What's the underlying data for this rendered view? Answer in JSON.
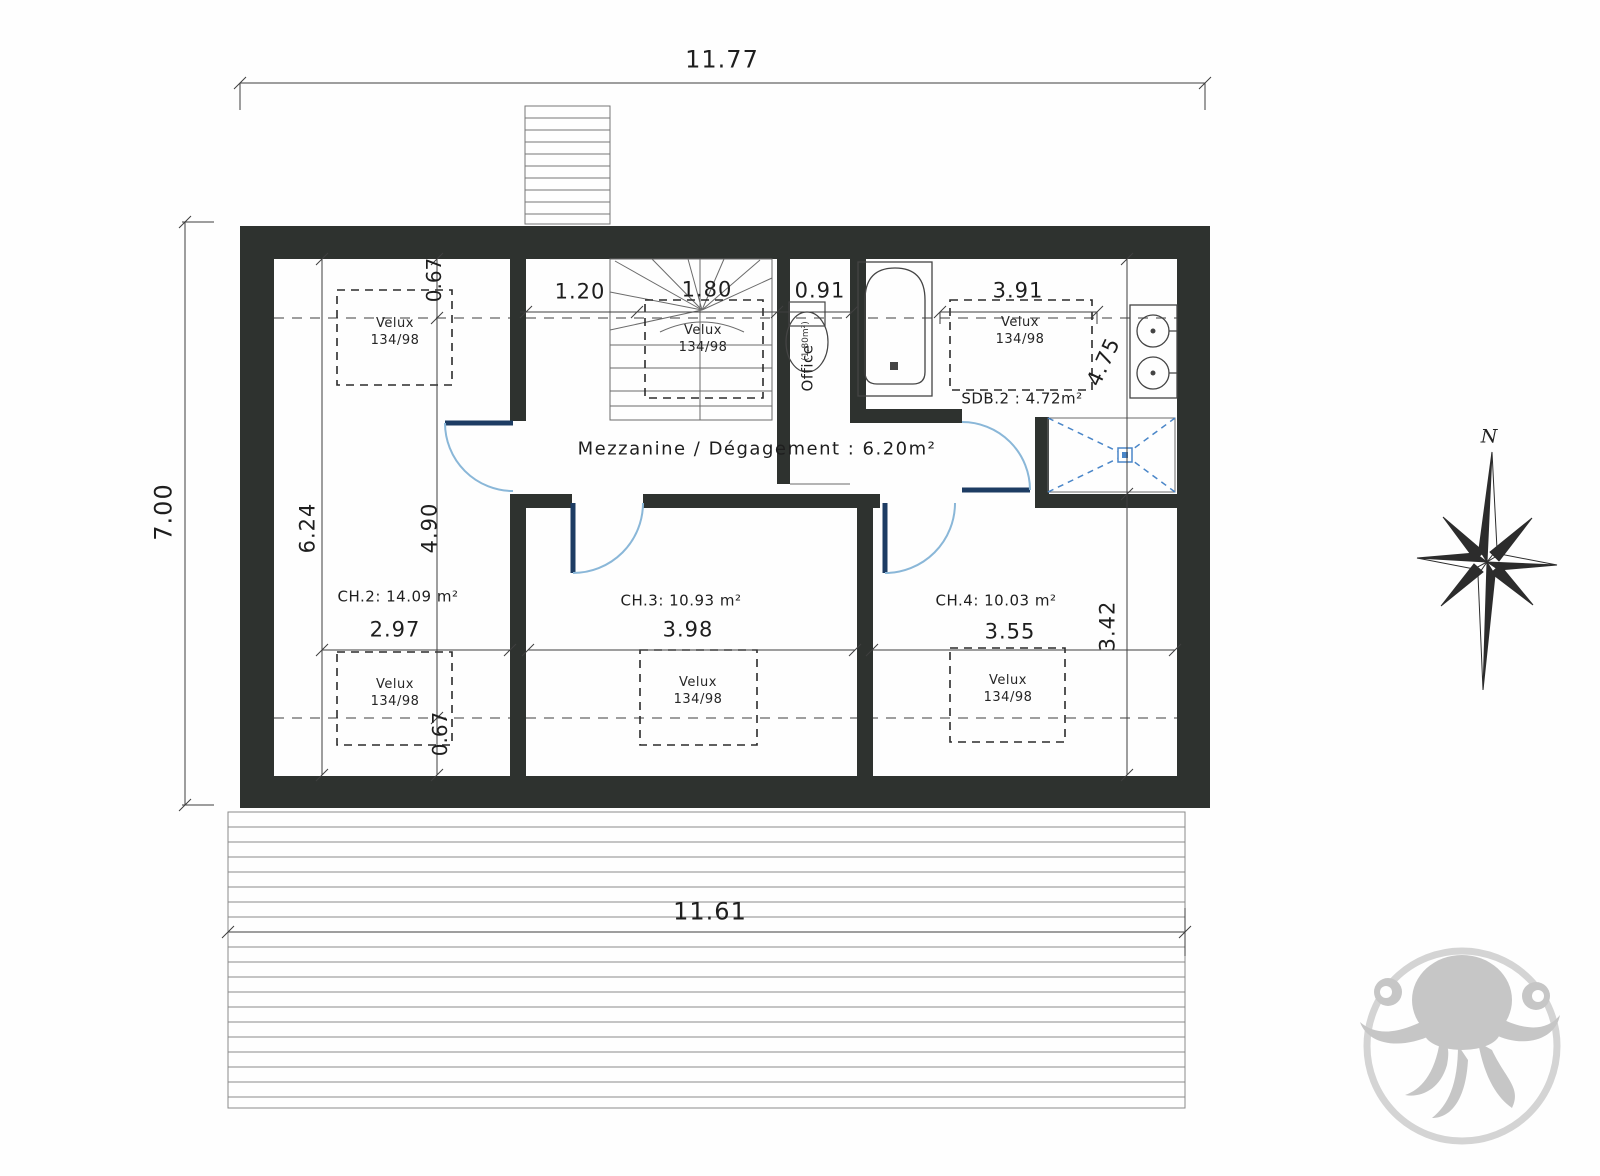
{
  "plan": {
    "dims": {
      "overall_top": "11.77",
      "overall_left": "7.00",
      "terrace_bottom": "11.61",
      "mezzanine_left": "1.20",
      "stairs_width": "1.80",
      "office_width": "0.91",
      "sdb2_width": "3.91",
      "ch2_top_offset": "0.67",
      "ch2_left_depth": "6.24",
      "ch2_inner_depth": "4.90",
      "sdb2_depth": "4.75",
      "ch4_depth": "3.42",
      "ch2_width": "2.97",
      "ch3_width": "3.98",
      "ch4_width": "3.55",
      "ch2_bottom_offset": "0.67"
    },
    "rooms": {
      "ch2": "CH.2: 14.09 m²",
      "ch3": "CH.3: 10.93 m²",
      "ch4": "CH.4: 10.03 m²",
      "mezzanine": "Mezzanine / Dégagement : 6.20m²",
      "sdb2": "SDB.2 : 4.72m²",
      "office": "Office",
      "office_area": "(1,80m²)"
    },
    "velux": {
      "text": "Velux\n134/98"
    },
    "compass": {
      "north": "N"
    },
    "colors": {
      "wall": "#2e322f",
      "door_leaf": "#1d3c63",
      "door_arc": "#8ab7d8",
      "shower_blue": "#4a86c8",
      "linework": "#4a4a4a",
      "watermark": "#909090"
    }
  }
}
